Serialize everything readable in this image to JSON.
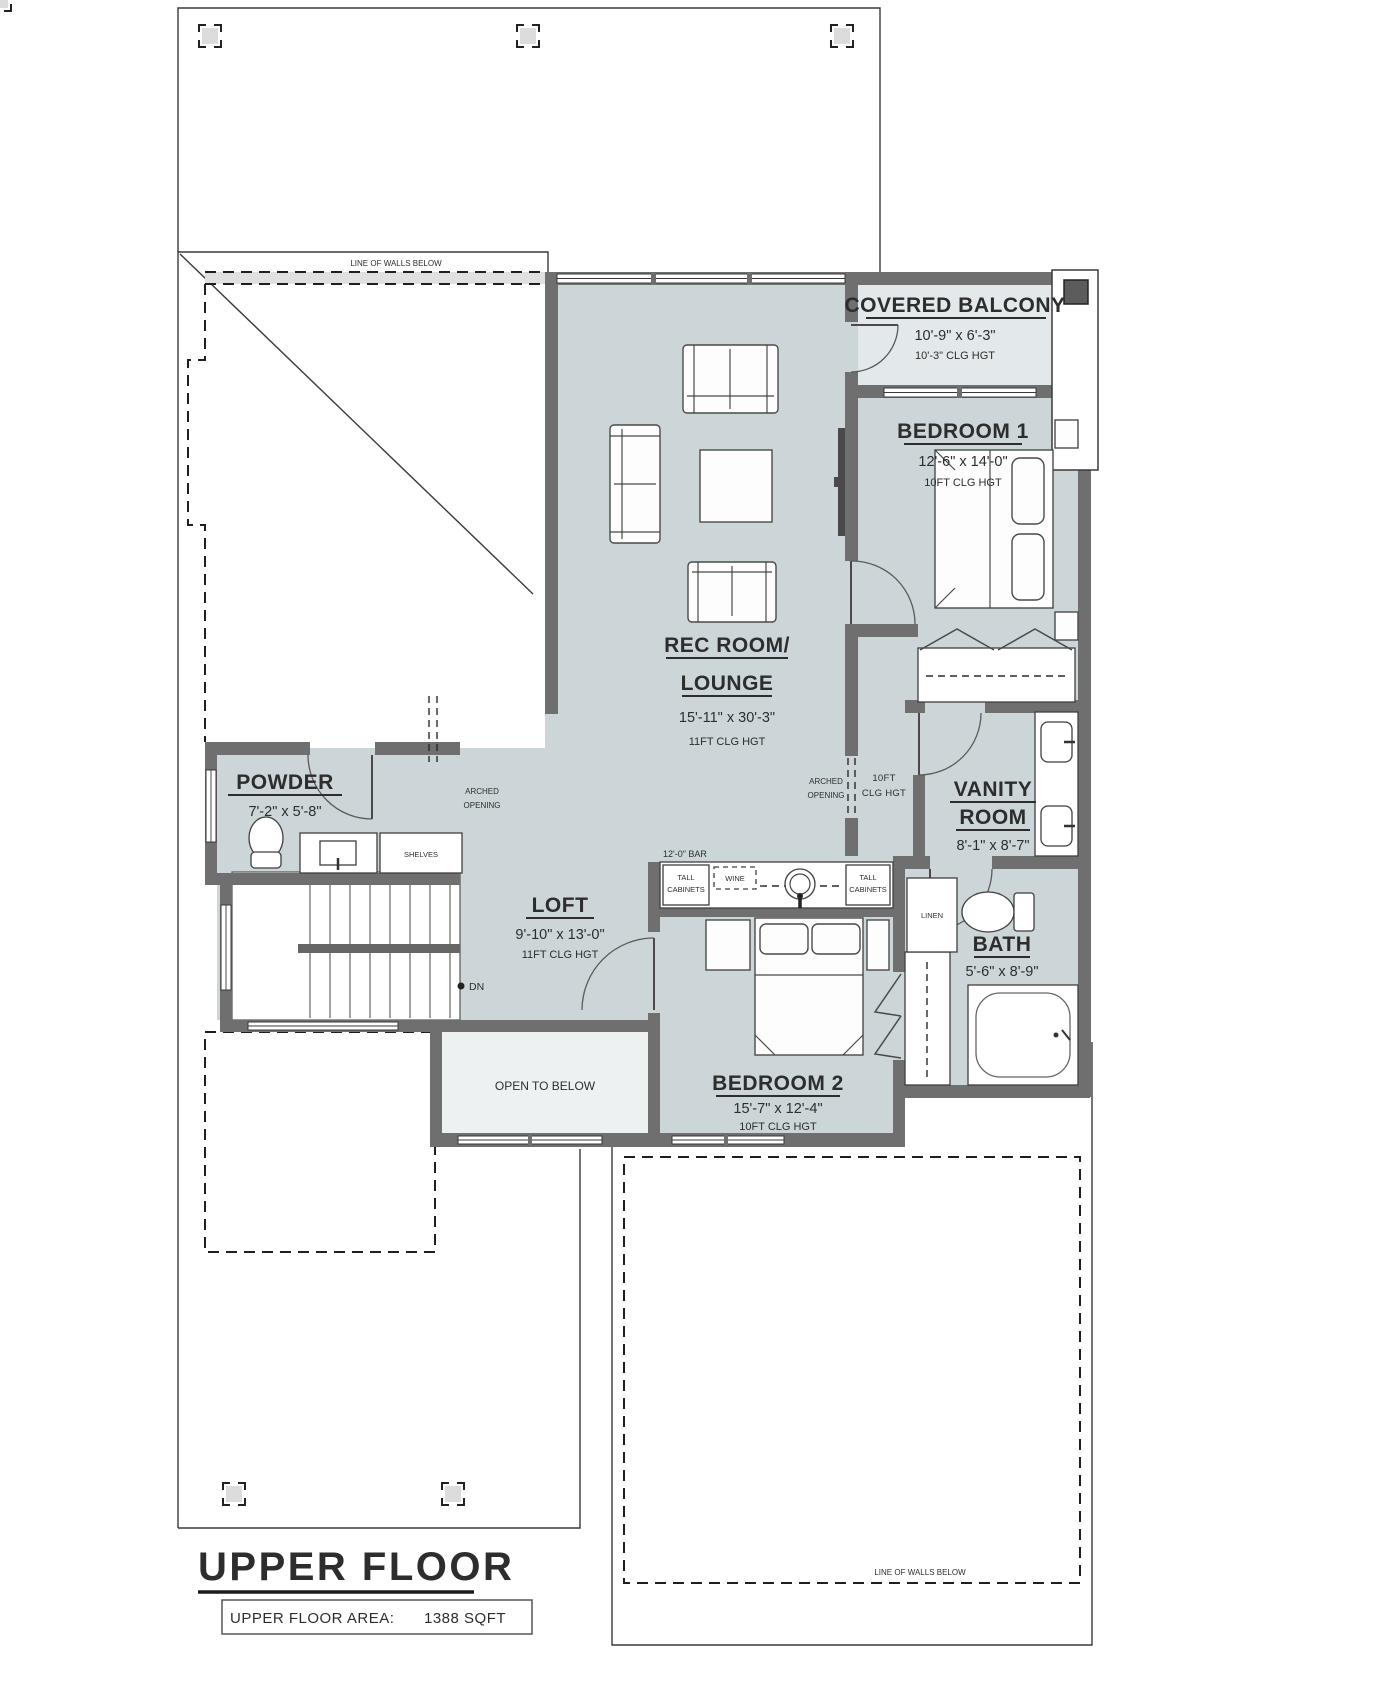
{
  "plan": {
    "title": "UPPER FLOOR",
    "area_label": "UPPER FLOOR AREA:",
    "area_value": "1388 SQFT",
    "colors": {
      "wall": "#6f6f6f",
      "room_fill": "#ccd6d8",
      "light_fill": "#e3e9ea",
      "open_below_fill": "#eef1f1"
    },
    "rooms": {
      "covered_balcony": {
        "name": "COVERED BALCONY",
        "dims": "10'-9\" x 6'-3\"",
        "ceiling": "10'-3\" CLG HGT"
      },
      "bedroom1": {
        "name": "BEDROOM 1",
        "dims": "12'-6\" x 14'-0\"",
        "ceiling": "10FT CLG HGT"
      },
      "rec_room": {
        "name_line1": "REC ROOM/",
        "name_line2": "LOUNGE",
        "dims": "15'-11\" x 30'-3\"",
        "ceiling": "11FT CLG HGT"
      },
      "powder": {
        "name": "POWDER",
        "dims": "7'-2\" x 5'-8\""
      },
      "vanity": {
        "name_line1": "VANITY",
        "name_line2": "ROOM",
        "dims": "8'-1\" x 8'-7\""
      },
      "loft": {
        "name": "LOFT",
        "dims": "9'-10\" x 13'-0\"",
        "ceiling": "11FT CLG HGT"
      },
      "bedroom2": {
        "name": "BEDROOM 2",
        "dims": "15'-7\" x 12'-4\"",
        "ceiling": "10FT CLG HGT"
      },
      "bath": {
        "name": "BATH",
        "dims": "5'-6\" x 8'-9\""
      }
    },
    "annotations": {
      "line_of_walls_below_top": "LINE OF WALLS BELOW",
      "line_of_walls_below_bottom": "LINE OF WALLS BELOW",
      "arched_opening_line1": "ARCHED",
      "arched_opening_line2": "OPENING",
      "hall_ceiling_line1": "10FT",
      "hall_ceiling_line2": "CLG HGT",
      "open_to_below": "OPEN TO BELOW",
      "down": "DN",
      "shelves": "SHELVES",
      "linen": "LINEN",
      "bar_label": "12'-0\" BAR",
      "tall_cabinets_line1": "TALL",
      "tall_cabinets_line2": "CABINETS",
      "wine": "WINE"
    }
  }
}
